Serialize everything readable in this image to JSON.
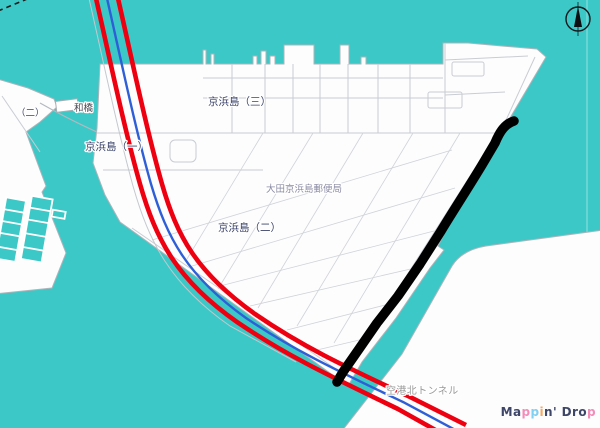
{
  "labels": {
    "keihinjima_3": "京浜島（三）",
    "keihinjima_1": "京浜島（一）",
    "keihinjima_2": "京浜島（二）",
    "post_office": "大田京浜島郵便局",
    "tunnel": "空港北トンネル",
    "bridge": "和橋",
    "west_district": "（二）"
  },
  "colors": {
    "water": "#3CC8C6",
    "land": "#FDFDFE",
    "expressway_red": "#EE0010",
    "line_blue": "#2F5FD6",
    "annotation_black": "#000000",
    "street_gray": "#C9CCD3",
    "district_label": "#3A4168",
    "poi_label": "#8B8BA4",
    "tunnel_label": "#9A9A9A"
  },
  "annotation": {
    "type": "freehand-stroke",
    "color": "#000000",
    "location": "along east coast of Keihinjima"
  },
  "icons": {
    "compass": "north-arrow-icon"
  },
  "watermark": {
    "text": "Mappin' Drop",
    "letters": [
      {
        "ch": "M",
        "color": "#3E4668"
      },
      {
        "ch": "a",
        "color": "#3E4668"
      },
      {
        "ch": "p",
        "color": "#F28CB8"
      },
      {
        "ch": "p",
        "color": "#7FD0F2"
      },
      {
        "ch": "i",
        "color": "#F5A95E"
      },
      {
        "ch": "n",
        "color": "#3E4668"
      },
      {
        "ch": "'",
        "color": "#3E4668"
      },
      {
        "ch": " ",
        "color": "#3E4668"
      },
      {
        "ch": "D",
        "color": "#3E4668"
      },
      {
        "ch": "r",
        "color": "#3E4668"
      },
      {
        "ch": "o",
        "color": "#3E4668"
      },
      {
        "ch": "p",
        "color": "#F28CB8"
      }
    ]
  }
}
